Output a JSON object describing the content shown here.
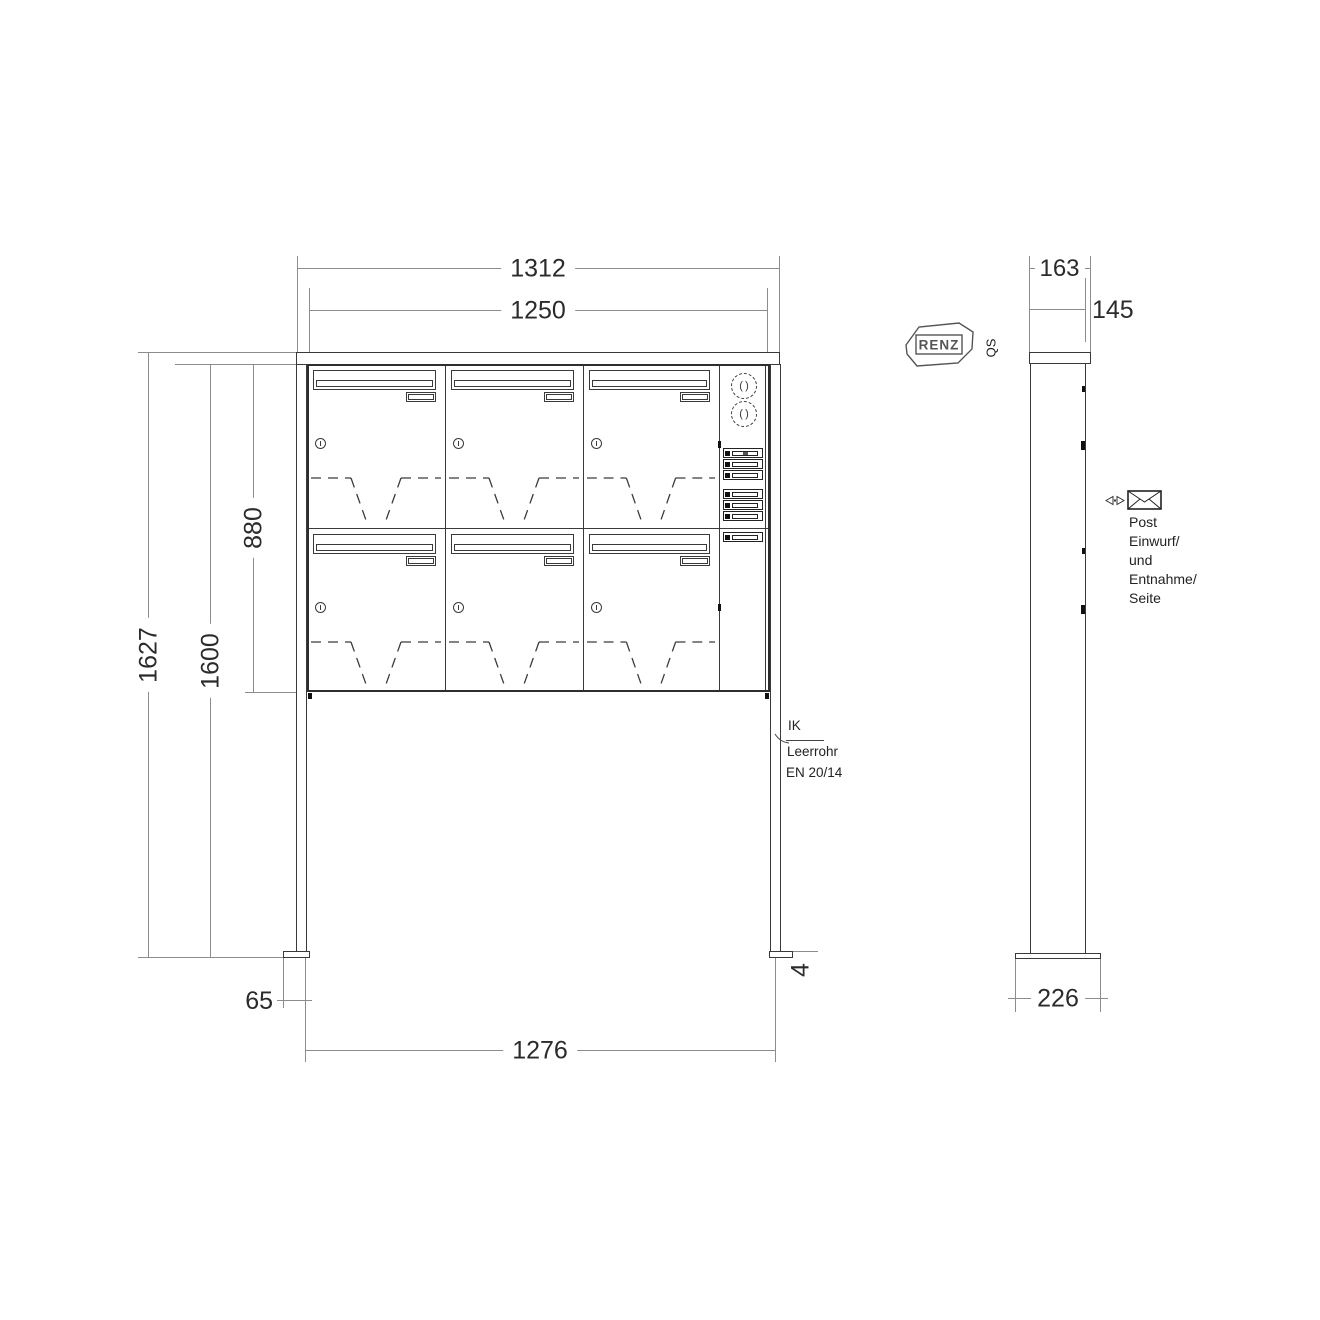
{
  "drawing": {
    "front_view": {
      "dim_overall_width": "1312",
      "dim_body_width": "1250",
      "dim_total_height": "1627",
      "dim_post_height": "1600",
      "dim_body_height": "880",
      "dim_foot_offset": "65",
      "dim_anchor_width": "1276",
      "dim_foot_plate_thickness": "4",
      "note_ik": "IK",
      "note_leerrohr": "Leerrohr",
      "note_en": "EN 20/14"
    },
    "side_view": {
      "dim_overall_depth": "163",
      "dim_body_depth": "145",
      "dim_foot_depth": "226",
      "note_lines": [
        "Post",
        "Einwurf/",
        "und",
        "Entnahme/",
        "Seite"
      ]
    },
    "branding": {
      "logo_text": "RENZ",
      "qs_text": "QS"
    },
    "icons": {
      "speaker": "speaker-grille",
      "envelope": "mail-envelope",
      "eye": "view-direction"
    },
    "colors": {
      "object_line": "#3a3a3a",
      "dimension_line": "#8c8c8c",
      "text": "#2b2b2b",
      "background": "#ffffff"
    }
  }
}
